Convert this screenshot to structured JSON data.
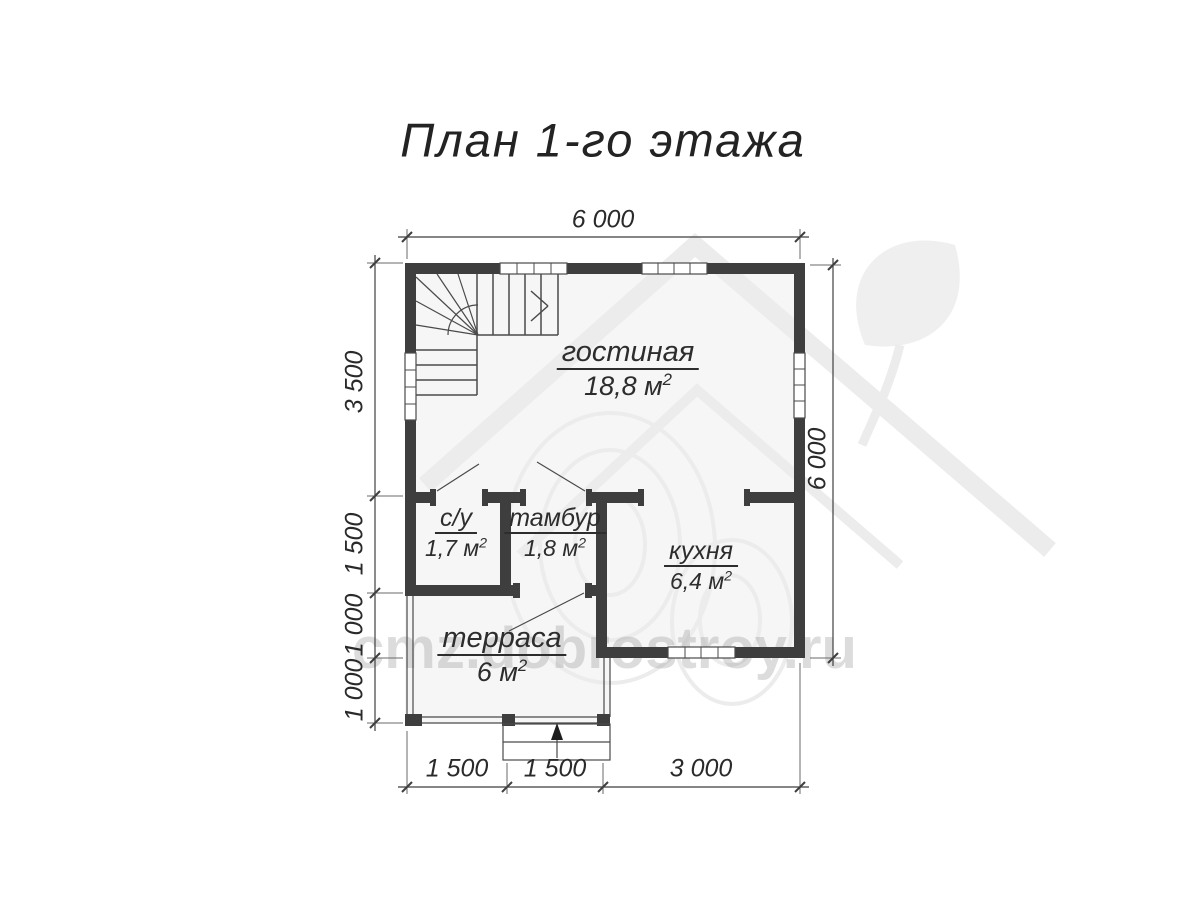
{
  "title": "План 1-го этажа",
  "watermark": {
    "text": "cmz.dobrostroy.ru",
    "logo": "house-with-leaf"
  },
  "rooms": {
    "living": {
      "name": "гостиная",
      "area": "18,8 м",
      "sup": "2"
    },
    "wc": {
      "name": "с/у",
      "area": "1,7 м",
      "sup": "2"
    },
    "vestibule": {
      "name": "тамбур",
      "area": "1,8 м",
      "sup": "2"
    },
    "kitchen": {
      "name": "кухня",
      "area": "6,4 м",
      "sup": "2"
    },
    "terrace": {
      "name": "терраса",
      "area": "6 м",
      "sup": "2"
    }
  },
  "dimensions": {
    "top": {
      "width": "6 000"
    },
    "right": {
      "height": "6 000"
    },
    "left": {
      "d1": "3 500",
      "d2": "1 500",
      "d3": "1 000",
      "d4": "1 000"
    },
    "bottom": {
      "d1": "1 500",
      "d2": "1 500",
      "d3": "3 000"
    }
  },
  "colors": {
    "wall": "#3e3e3e",
    "line": "#4a4a4a",
    "floor": "#f6f6f6",
    "text": "#2d2d2d",
    "dim": "#3f3f3f",
    "wmk": "#ececec",
    "wmkf": "#efefef"
  }
}
